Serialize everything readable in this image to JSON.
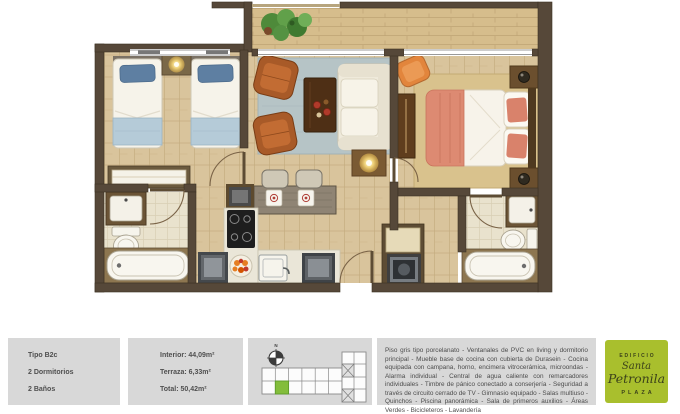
{
  "unit_card": {
    "type_label": "Tipo B2c",
    "bedrooms_label": "2 Dormitorios",
    "bathrooms_label": "2 Baños"
  },
  "areas_card": {
    "interior": "Interior: 44,09m²",
    "terrace": "Terraza: 6,33m²",
    "total": "Total: 50,42m²"
  },
  "key_plan": {
    "north_label": "N",
    "highlight_color": "#83bd3b"
  },
  "description_card": {
    "text": "Piso gris tipo porcelanato - Ventanales de PVC en living y dormitorio principal - Mueble base de cocina con cubierta de Durasein - Cocina equipada con campana, horno, encimera vitrocerámica, microondas - Alarma individual - Central de agua caliente con remarcadores individuales - Timbre de pánico conectado a conserjería - Seguridad a través de circuito cerrado de TV - Gimnasio equipado - Salas multiuso - Quinchos - Piscina panorámica - Sala de primeros auxilios - Áreas Verdes - Bicicleteros - Lavandería"
  },
  "logo_card": {
    "building_label": "EDIFICIO",
    "name_line1": "Santa",
    "name_line2": "Petronila",
    "plaza_label": "PLAZA",
    "bg_color": "#a9bf2d",
    "text_color": "#3c421a"
  },
  "palette": {
    "wall": "#564839",
    "wood_floor": "#d9c49c",
    "terrace_floor": "#d6bd8c",
    "bath_tile": "#e9e2cd",
    "living_rug": "#b6c4c6",
    "master_rug": "#d9c28d",
    "panel_gray": "#d8d8d8"
  }
}
